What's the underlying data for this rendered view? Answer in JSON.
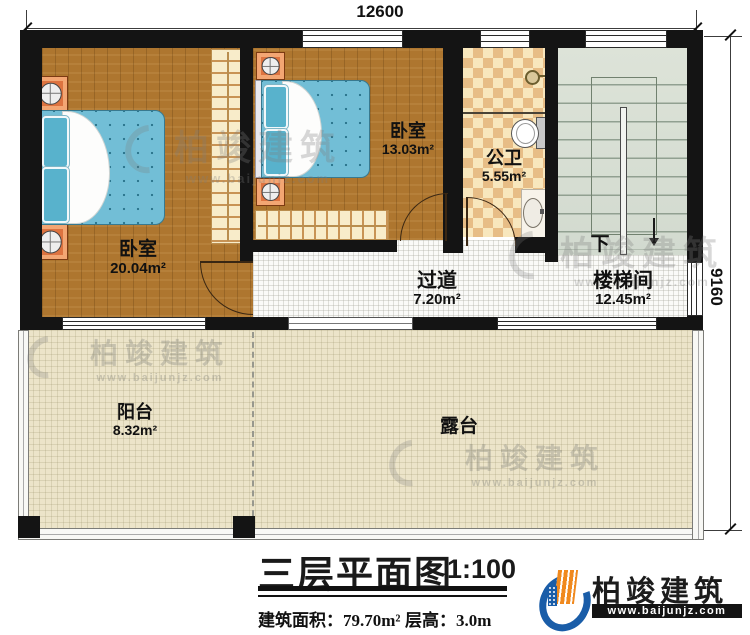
{
  "dimensions": {
    "top": "12600",
    "right": "9160"
  },
  "rooms": {
    "bedroom1": {
      "name": "卧室",
      "area": "20.04m²"
    },
    "bedroom2": {
      "name": "卧室",
      "area": "13.03m²"
    },
    "bathroom": {
      "name": "公卫",
      "area": "5.55m²"
    },
    "corridor": {
      "name": "过道",
      "area": "7.20m²"
    },
    "stairwell": {
      "name": "楼梯间",
      "area": "12.45m²"
    },
    "balcony": {
      "name": "阳台",
      "area": "8.32m²"
    },
    "terrace": {
      "name": "露台"
    },
    "stairs_down": "下"
  },
  "title": {
    "text": "三层平面图",
    "scale": "1:100",
    "build_area_label": "建筑面积：",
    "build_area": "79.70m²",
    "floor_height_label": "层高：",
    "floor_height": "3.0m"
  },
  "brand": {
    "name": "柏竣建筑",
    "url": "www.baijunjz.com"
  },
  "watermark": {
    "name": "柏竣建筑",
    "url": "www.baijunjz.com"
  },
  "palette": {
    "wall": "#141414",
    "wood_floor": "#ae762f",
    "bathroom_tile": "#e7bd86",
    "stair_floor": "#d8dfd4",
    "corridor_tile": "#fafaf8",
    "terrace_floor": "#ece4c9",
    "bed_blue": "#72bed6",
    "nightstand_orange": "#dd7340",
    "wardrobe_cream": "#f8ecca",
    "brand_blue": "#1a5da8",
    "brand_orange": "#f0891e"
  }
}
